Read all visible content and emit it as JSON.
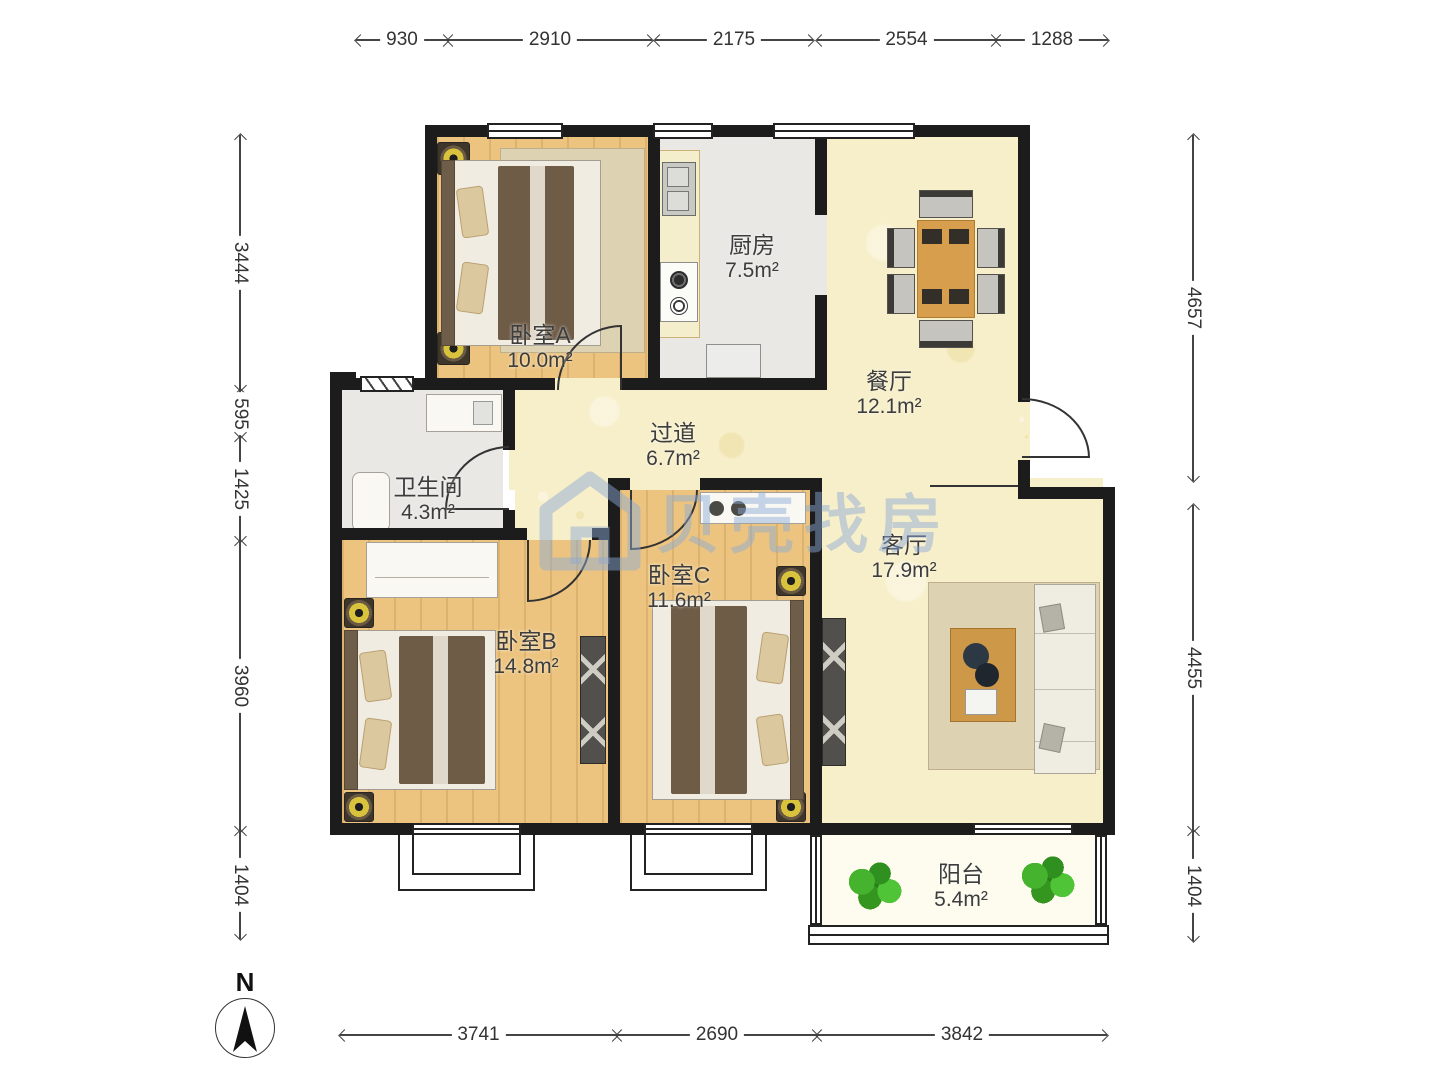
{
  "meta": {
    "compass_label": "N",
    "watermark": "贝壳找房"
  },
  "dimensions": {
    "top": [
      "930",
      "2910",
      "2175",
      "2554",
      "1288"
    ],
    "left": [
      "3444",
      "595",
      "1425",
      "3960",
      "1404"
    ],
    "right": [
      "4657",
      "4455",
      "1404"
    ],
    "bottom": [
      "3741",
      "2690",
      "3842"
    ]
  },
  "rooms": [
    {
      "name": "卧室A",
      "area": "10.0m²"
    },
    {
      "name": "厨房",
      "area": "7.5m²"
    },
    {
      "name": "餐厅",
      "area": "12.1m²"
    },
    {
      "name": "过道",
      "area": "6.7m²"
    },
    {
      "name": "卫生间",
      "area": "4.3m²"
    },
    {
      "name": "卧室B",
      "area": "14.8m²"
    },
    {
      "name": "卧室C",
      "area": "11.6m²"
    },
    {
      "name": "客厅",
      "area": "17.9m²"
    },
    {
      "name": "阳台",
      "area": "5.4m²"
    }
  ],
  "colors": {
    "wall": "#1c1c1c",
    "wood_floor": "#ecc47f",
    "tile_floor": "#e9e8e4",
    "hall_floor": "#f7efc9",
    "balcony_floor": "#fdfcee",
    "watermark_blue": "rgba(140,170,215,0.5)",
    "table_wood": "#d79e4d",
    "plant_green": "#46b32e"
  }
}
